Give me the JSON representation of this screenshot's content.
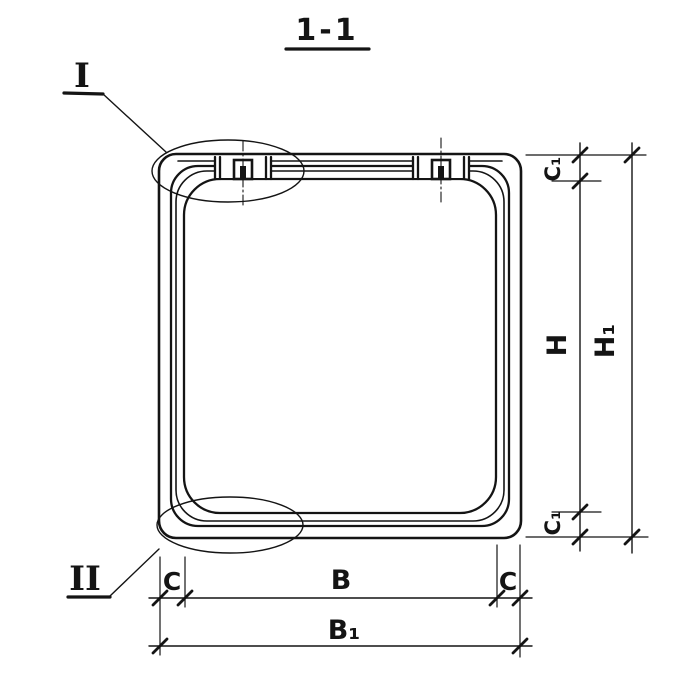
{
  "title": "1-1",
  "detail_markers": {
    "top": "I",
    "bottom": "II"
  },
  "dimensions": {
    "top_thickness": "C₁",
    "inner_height": "H",
    "overall_height": "H₁",
    "bottom_thickness": "C₁",
    "left_thickness": "C",
    "inner_width": "B",
    "right_thickness": "C",
    "overall_width": "B₁"
  },
  "colors": {
    "ink": "#141414",
    "paper": "#ffffff"
  }
}
